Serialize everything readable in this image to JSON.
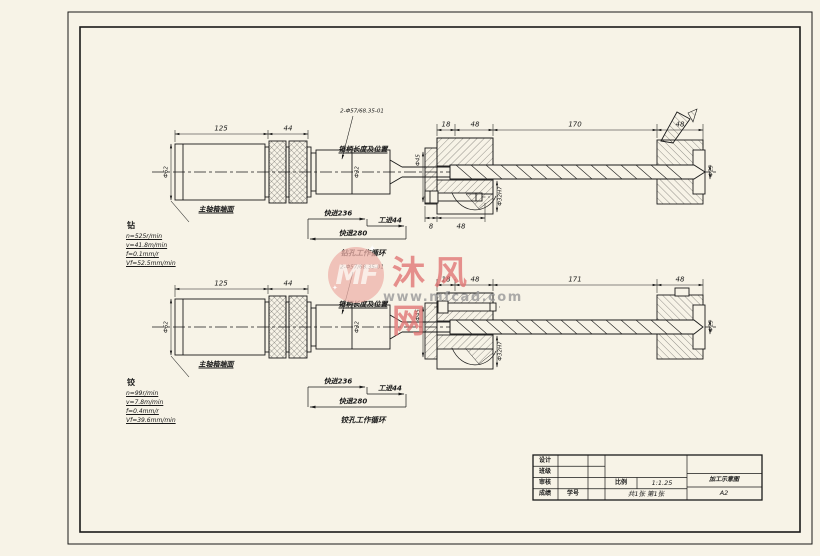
{
  "colors": {
    "line": "#1a1a1a",
    "paper": "#f7f3e7",
    "wm_red": "#e06e6e",
    "wm_pink": "#eeb2aa",
    "wm_gray": "#9e9e9e"
  },
  "watermark": {
    "logo": "MF",
    "brand": "沐风网",
    "url": "www.mfcad.com"
  },
  "top_view": {
    "dim_125": "125",
    "dim_44": "44",
    "dim_18": "18",
    "dim_48a": "48",
    "dim_170": "170",
    "dim_48b": "48",
    "dim_8": "8",
    "dim_48c": "48",
    "spec": "2-Ф57/68.35-01",
    "collet_note": "锥柄长度及位置",
    "spindle_face": "主轴箱端面",
    "dia_body": "Ф62",
    "dia_holder": "Ф32",
    "dia_plate": "Ф45",
    "dia_bush": "Ф32H7",
    "dia_tool": "Ф25",
    "cycle": {
      "rapid_in": "快进236",
      "work_feed": "工进44",
      "rapid_back": "快退280",
      "caption": "钻孔工作循环"
    },
    "notes": {
      "head": "钻",
      "n": "n=525r/min",
      "v": "v=41.8m/min",
      "f": "f=0.1mm/r",
      "vf": "Vf=52.5mm/min"
    }
  },
  "bottom_view": {
    "dim_125": "125",
    "dim_44": "44",
    "dim_18": "18",
    "dim_48a": "48",
    "dim_171": "171",
    "dim_48b": "48",
    "spec": "2-Ф57/68.35-01",
    "collet_note": "锥柄长度及位置",
    "spindle_face": "主轴箱端面",
    "dia_body": "Ф62",
    "dia_holder": "Ф32",
    "dia_plate": "Ф45",
    "dia_bush": "Ф32H7",
    "dia_tool": "Ф25",
    "cycle": {
      "rapid_in": "快进236",
      "work_feed": "工进44",
      "rapid_back": "快退280",
      "caption": "铰孔工作循环"
    },
    "notes": {
      "head": "铰",
      "n": "n=99r/min",
      "v": "v=7.8m/min",
      "f": "f=0.4mm/r",
      "vf": "Vf=39.6mm/min"
    }
  },
  "title_block": {
    "row1": "设计",
    "row2": "班级",
    "row3": "审核",
    "row4": "成绩",
    "student_no": "学号",
    "scale_label": "比例",
    "scale_value": "1:1.25",
    "sheet_info": "共1张 第1张",
    "drawing_title": "加工示意图",
    "paper_size": "A2"
  }
}
